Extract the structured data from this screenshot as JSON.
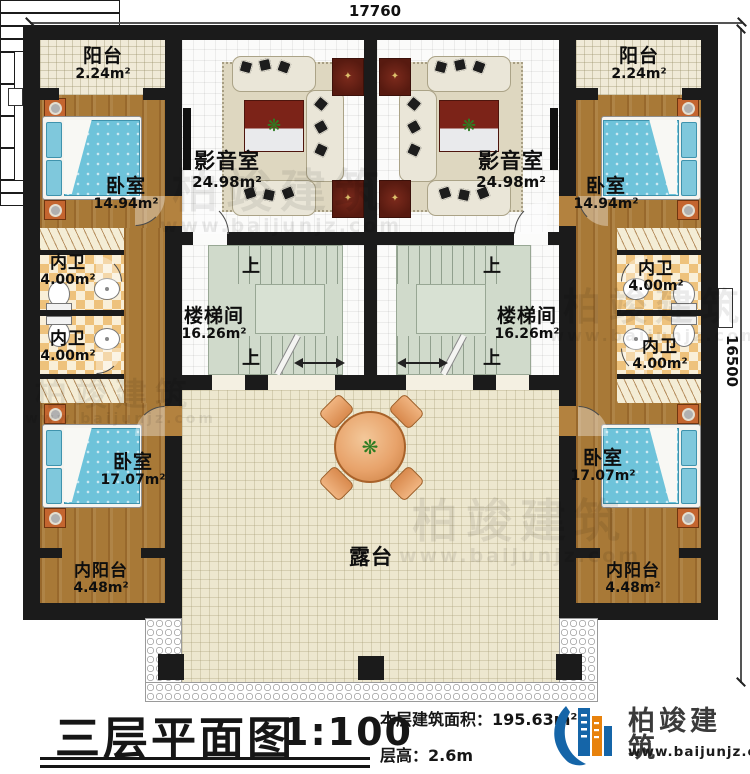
{
  "dimensions": {
    "top": "17760",
    "right": "16500"
  },
  "rooms": {
    "balcony": {
      "name": "阳台",
      "area": "2.24m²"
    },
    "bedroom_upper": {
      "name": "卧室",
      "area": "14.94m²"
    },
    "media": {
      "name": "影音室",
      "area": "24.98m²"
    },
    "bath": {
      "name": "内卫",
      "area": "4.00m²"
    },
    "stair": {
      "name": "楼梯间",
      "area": "16.26m²"
    },
    "bedroom_lower": {
      "name": "卧室",
      "area": "17.07m²"
    },
    "inner_balcony": {
      "name": "内阳台",
      "area": "4.48m²"
    },
    "terrace": {
      "name": "露台"
    },
    "up": "上"
  },
  "title_block": {
    "title": "三层平面图",
    "scale": "1:100",
    "area_label": "本层建筑面积：",
    "area_value": "195.63m²",
    "height_label": "层高：",
    "height_value": "2.6m"
  },
  "branding": {
    "company": "柏竣建筑",
    "website": "www.baijunjz.com"
  },
  "colors": {
    "wall": "#1b1b1b",
    "wood": "#a87937",
    "brand_blue": "#1565a8",
    "brand_orange": "#e8820c",
    "accent_red": "#5e1b12"
  }
}
